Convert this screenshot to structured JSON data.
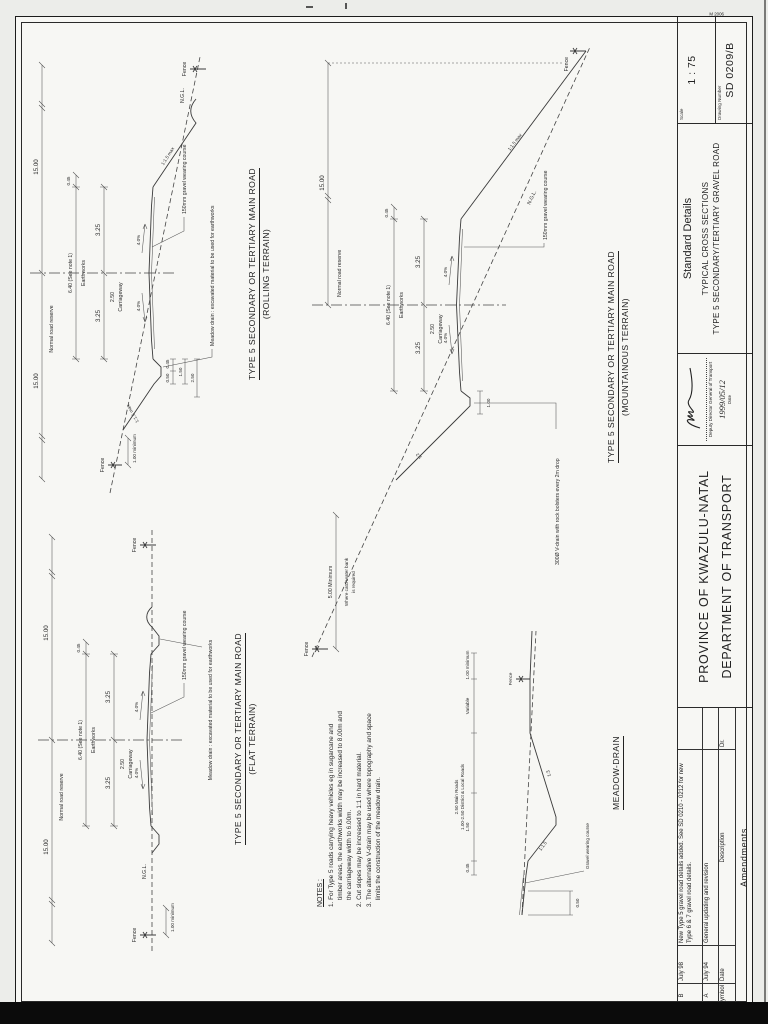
{
  "titleblock": {
    "province": "PROVINCE OF KWAZULU-NATAL",
    "department": "DEPARTMENT OF TRANSPORT",
    "standard_details": "Standard Details",
    "title_line1": "TYPICAL CROSS SECTIONS",
    "title_line2": "TYPE 5 SECONDARY/TERTIARY GRAVEL ROAD",
    "scale_label": "Scale",
    "scale_value": "1 : 75",
    "number_label": "Drawing Number",
    "number_value": "SD 0209/B",
    "form_no": "M 2006",
    "signature_role": "Deputy Director General of Transport",
    "signature_date": "1999/05/12",
    "signature_date_label": "Date"
  },
  "revisions": {
    "headers": {
      "symbol": "Symbol",
      "date": "Date",
      "description": "Description",
      "dr": "Dr."
    },
    "rows": [
      {
        "symbol": "B",
        "date": "July 98",
        "description": "New Type 5 gravel road details added. See SD 0210 - 0212 for new Type 6 & 7 gravel road details."
      },
      {
        "symbol": "A",
        "date": "July 94",
        "description": "General updating and revision"
      }
    ],
    "footer": "Amendments"
  },
  "sections": {
    "flat": {
      "title": "TYPE 5 SECONDARY OR TERTIARY MAIN ROAD",
      "subtitle": "(FLAT TERRAIN)"
    },
    "rolling": {
      "title": "TYPE 5 SECONDARY OR TERTIARY MAIN ROAD",
      "subtitle": "(ROLLING TERRAIN)"
    },
    "mountainous": {
      "title": "TYPE 5 SECONDARY OR TERTIARY MAIN ROAD",
      "subtitle": "(MOUNTAINOUS TERRAIN)"
    },
    "meadow": {
      "title": "MEADOW-DRAIN"
    }
  },
  "labels": {
    "reserve": "15.00",
    "reserve_name": "Normal road reserve",
    "earthworks_val": "6.40 (See note 1)",
    "earthworks_name": "Earthworks",
    "cway_val": "2.50",
    "cway_name": "Carriageway",
    "half": "3.25",
    "edge": "0.45",
    "crossfall": "4.0%",
    "wearing": "150mm gravel wearing course",
    "ngl": "N.G.L.",
    "slope15": "1:1.5 max",
    "slope12": "1:2",
    "fence": "Fence",
    "min1": "1.00 minimum",
    "meadow_note": "Meadow drain : excavated material to be used for earthworks",
    "d050": "0.50",
    "d100": "1.00",
    "d150": "1.50",
    "d250": "2.50",
    "min5": "5.00 Minimum",
    "wherecut_a": "Where catchwater bank",
    "wherecut_b": "is required",
    "vdrain": "300Ø V-drain with rock bolsters every 2m drop"
  },
  "meadow_detail": {
    "m045": "0.45",
    "m150": "1.50",
    "m250a": "2.50 Main Roads",
    "m250b": "1.00-2.50 District & Local Roads",
    "variable": "Variable",
    "min1": "1.00 minimum",
    "fence": "Fence",
    "gravel": "Gravel wearing course",
    "d050": "0.50",
    "slope_road": "1:1.5",
    "slope_outer": "1:3"
  },
  "notes": {
    "title": "NOTES :",
    "items": [
      "1. For Type 5 roads carrying heavy vehicles eg in sugarcane and timber areas, the earthworks width may be increased to 8.00m and the carriageway width to 6.00m.",
      "2. Cut slopes may be increased to 1:1 in hard material.",
      "3. The alternative V-drain may be used where topography and space limits the construction of the meadow drain."
    ]
  }
}
